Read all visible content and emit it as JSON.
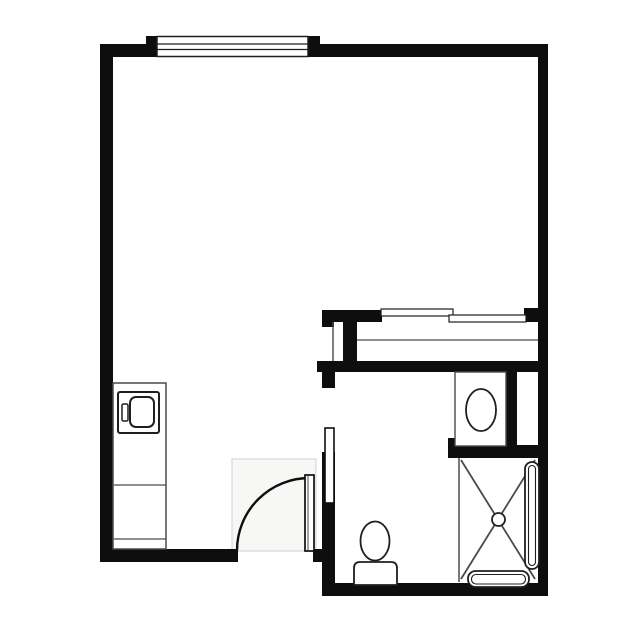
{
  "canvas": {
    "width": 636,
    "height": 636,
    "background": "#ffffff"
  },
  "palette": {
    "wall": "#0e0e0e",
    "fixture": "#1f1f1f",
    "line": "#4a4a4a",
    "swing_fill": "#f7f7f6",
    "swing_stroke": "#d8d8d8",
    "white": "#ffffff"
  },
  "shapes": [
    {
      "name": "door-swing-area",
      "type": "rect",
      "attrs": {
        "x": 232,
        "y": 459,
        "width": 84,
        "height": 92
      },
      "fill": "swing_fill",
      "stroke": "swing_stroke",
      "sw": 1.2
    },
    {
      "name": "wall-top-left",
      "type": "rect",
      "attrs": {
        "x": 100,
        "y": 44,
        "width": 46,
        "height": 13
      },
      "fill": "wall"
    },
    {
      "name": "window-jamb-left",
      "type": "rect",
      "attrs": {
        "x": 146,
        "y": 36,
        "width": 12,
        "height": 21
      },
      "fill": "wall"
    },
    {
      "name": "window-jamb-right",
      "type": "rect",
      "attrs": {
        "x": 308,
        "y": 36,
        "width": 12,
        "height": 21
      },
      "fill": "wall"
    },
    {
      "name": "wall-top-right",
      "type": "rect",
      "attrs": {
        "x": 320,
        "y": 44,
        "width": 228,
        "height": 13
      },
      "fill": "wall"
    },
    {
      "name": "wall-left",
      "type": "rect",
      "attrs": {
        "x": 100,
        "y": 44,
        "width": 13,
        "height": 518
      },
      "fill": "wall"
    },
    {
      "name": "wall-right",
      "type": "rect",
      "attrs": {
        "x": 538,
        "y": 44,
        "width": 10,
        "height": 552
      },
      "fill": "wall"
    },
    {
      "name": "wall-bottom-main",
      "type": "rect",
      "attrs": {
        "x": 100,
        "y": 549,
        "width": 138,
        "height": 13
      },
      "fill": "wall"
    },
    {
      "name": "wall-entry-right-stub",
      "type": "rect",
      "attrs": {
        "x": 313,
        "y": 549,
        "width": 12,
        "height": 13
      },
      "fill": "wall"
    },
    {
      "name": "wall-closet-top",
      "type": "rect",
      "attrs": {
        "x": 322,
        "y": 310,
        "width": 60,
        "height": 12
      },
      "fill": "wall"
    },
    {
      "name": "wall-closet-top-cap",
      "type": "rect",
      "attrs": {
        "x": 322,
        "y": 310,
        "width": 12,
        "height": 17
      },
      "fill": "wall"
    },
    {
      "name": "wall-closet-right-stub",
      "type": "rect",
      "attrs": {
        "x": 524,
        "y": 308,
        "width": 16,
        "height": 14
      },
      "fill": "wall"
    },
    {
      "name": "wall-closet-divider",
      "type": "rect",
      "attrs": {
        "x": 343,
        "y": 322,
        "width": 14,
        "height": 40
      },
      "fill": "wall"
    },
    {
      "name": "wall-closet-bottom",
      "type": "rect",
      "attrs": {
        "x": 317,
        "y": 361,
        "width": 231,
        "height": 11
      },
      "fill": "wall"
    },
    {
      "name": "wall-bath-door-stub",
      "type": "rect",
      "attrs": {
        "x": 322,
        "y": 372,
        "width": 13,
        "height": 16
      },
      "fill": "wall"
    },
    {
      "name": "wall-bath-left",
      "type": "rect",
      "attrs": {
        "x": 322,
        "y": 452,
        "width": 13,
        "height": 144
      },
      "fill": "wall"
    },
    {
      "name": "wall-vanity-right",
      "type": "rect",
      "attrs": {
        "x": 506,
        "y": 372,
        "width": 11,
        "height": 74
      },
      "fill": "wall"
    },
    {
      "name": "wall-above-shower",
      "type": "rect",
      "attrs": {
        "x": 448,
        "y": 445,
        "width": 100,
        "height": 13
      },
      "fill": "wall"
    },
    {
      "name": "wall-above-shower-cap",
      "type": "rect",
      "attrs": {
        "x": 448,
        "y": 438,
        "width": 10,
        "height": 8
      },
      "fill": "wall"
    },
    {
      "name": "wall-bath-bottom",
      "type": "rect",
      "attrs": {
        "x": 322,
        "y": 583,
        "width": 226,
        "height": 13
      },
      "fill": "wall"
    },
    {
      "name": "window-frame",
      "type": "rect",
      "attrs": {
        "x": 157,
        "y": 36.5,
        "width": 151,
        "height": 20
      },
      "fill": "white",
      "stroke": "fixture",
      "sw": 1.5
    },
    {
      "name": "window-mullion-upper",
      "type": "line",
      "attrs": {
        "x1": 157,
        "y1": 44,
        "x2": 308,
        "y2": 44
      },
      "stroke": "fixture",
      "sw": 1.2
    },
    {
      "name": "window-mullion-lower",
      "type": "line",
      "attrs": {
        "x1": 157,
        "y1": 49.5,
        "x2": 308,
        "y2": 49.5
      },
      "stroke": "fixture",
      "sw": 1.2
    },
    {
      "name": "closet-side-line",
      "type": "line",
      "attrs": {
        "x1": 333,
        "y1": 322,
        "x2": 333,
        "y2": 361
      },
      "stroke": "line",
      "sw": 1.4
    },
    {
      "name": "closet-shelf-line",
      "type": "line",
      "attrs": {
        "x1": 357,
        "y1": 340,
        "x2": 538,
        "y2": 340
      },
      "stroke": "line",
      "sw": 1.3
    },
    {
      "name": "closet-sliding-door-left",
      "type": "rect",
      "attrs": {
        "x": 381,
        "y": 309,
        "width": 72,
        "height": 7
      },
      "fill": "white",
      "stroke": "fixture",
      "sw": 1.2
    },
    {
      "name": "closet-sliding-door-right",
      "type": "rect",
      "attrs": {
        "x": 449,
        "y": 315,
        "width": 77,
        "height": 7
      },
      "fill": "white",
      "stroke": "fixture",
      "sw": 1.2
    },
    {
      "name": "kitchenette-cabinet",
      "type": "rect",
      "attrs": {
        "x": 113,
        "y": 383,
        "width": 53,
        "height": 166
      },
      "fill": "white",
      "stroke": "line",
      "sw": 1.5
    },
    {
      "name": "cabinet-shelf-line-upper",
      "type": "line",
      "attrs": {
        "x1": 114,
        "y1": 485,
        "x2": 166,
        "y2": 485
      },
      "stroke": "line",
      "sw": 1.2
    },
    {
      "name": "cabinet-shelf-line-lower",
      "type": "line",
      "attrs": {
        "x1": 114,
        "y1": 539,
        "x2": 166,
        "y2": 539
      },
      "stroke": "line",
      "sw": 1.2
    },
    {
      "name": "appliance-body",
      "type": "rect",
      "attrs": {
        "x": 118,
        "y": 392,
        "width": 41,
        "height": 41,
        "rx": 2
      },
      "fill": "white",
      "stroke": "fixture",
      "sw": 2
    },
    {
      "name": "appliance-door",
      "type": "rect",
      "attrs": {
        "x": 130,
        "y": 397,
        "width": 24,
        "height": 30,
        "rx": 6
      },
      "fill": "white",
      "stroke": "fixture",
      "sw": 2
    },
    {
      "name": "appliance-handle",
      "type": "rect",
      "attrs": {
        "x": 122,
        "y": 404,
        "width": 6,
        "height": 17,
        "rx": 1.5
      },
      "fill": "white",
      "stroke": "fixture",
      "sw": 1.5
    },
    {
      "name": "entry-door-swing-arc",
      "type": "path",
      "attrs": {
        "d": "M 309.5 478 A 72.5 72.5 0 0 0 237 550.5"
      },
      "fill": "none",
      "stroke": "wall",
      "sw": 2.4
    },
    {
      "name": "entry-door-leaf",
      "type": "rect",
      "attrs": {
        "x": 305,
        "y": 475,
        "width": 9,
        "height": 76
      },
      "fill": "white",
      "stroke": "wall",
      "sw": 1.7
    },
    {
      "name": "entry-door-leaf-inner-line",
      "type": "line",
      "attrs": {
        "x1": 308,
        "y1": 476,
        "x2": 308,
        "y2": 550
      },
      "stroke": "line",
      "sw": 1
    },
    {
      "name": "bathroom-pocket-door-panel",
      "type": "rect",
      "attrs": {
        "x": 325,
        "y": 428,
        "width": 9,
        "height": 75
      },
      "fill": "white",
      "stroke": "wall",
      "sw": 1.6
    },
    {
      "name": "vanity-counter",
      "type": "rect",
      "attrs": {
        "x": 455,
        "y": 372,
        "width": 51,
        "height": 74
      },
      "fill": "white",
      "stroke": "line",
      "sw": 1.4
    },
    {
      "name": "vanity-sink-basin",
      "type": "ellipse",
      "attrs": {
        "cx": 481,
        "cy": 410,
        "rx": 15,
        "ry": 21
      },
      "fill": "white",
      "stroke": "fixture",
      "sw": 1.8
    },
    {
      "name": "shower-curb-line",
      "type": "line",
      "attrs": {
        "x1": 459,
        "y1": 458,
        "x2": 459,
        "y2": 582
      },
      "stroke": "line",
      "sw": 1.5
    },
    {
      "name": "shower-diagonal-a",
      "type": "line",
      "attrs": {
        "x1": 461,
        "y1": 460,
        "x2": 535,
        "y2": 579
      },
      "stroke": "line",
      "sw": 1.8
    },
    {
      "name": "shower-diagonal-b",
      "type": "line",
      "attrs": {
        "x1": 535,
        "y1": 460,
        "x2": 461,
        "y2": 579
      },
      "stroke": "line",
      "sw": 1.8
    },
    {
      "name": "shower-grab-bar-right",
      "type": "rect",
      "attrs": {
        "x": 525,
        "y": 462,
        "width": 14,
        "height": 107,
        "rx": 7
      },
      "fill": "white",
      "stroke": "fixture",
      "sw": 1.8
    },
    {
      "name": "shower-grab-bar-right-inner",
      "type": "rect",
      "attrs": {
        "x": 528.5,
        "y": 465.5,
        "width": 7,
        "height": 100,
        "rx": 3.5
      },
      "fill": "none",
      "stroke": "fixture",
      "sw": 1.1
    },
    {
      "name": "shower-grab-bar-bottom",
      "type": "rect",
      "attrs": {
        "x": 468,
        "y": 571,
        "width": 61,
        "height": 16,
        "rx": 7.5
      },
      "fill": "white",
      "stroke": "fixture",
      "sw": 1.8
    },
    {
      "name": "shower-grab-bar-bottom-inner",
      "type": "rect",
      "attrs": {
        "x": 471.5,
        "y": 574.5,
        "width": 54,
        "height": 9.5,
        "rx": 4.5
      },
      "fill": "none",
      "stroke": "fixture",
      "sw": 1.1
    },
    {
      "name": "shower-drain",
      "type": "circle",
      "attrs": {
        "cx": 498.5,
        "cy": 519.5,
        "r": 6.5
      },
      "fill": "white",
      "stroke": "fixture",
      "sw": 1.8
    },
    {
      "name": "toilet-bowl",
      "type": "ellipse",
      "attrs": {
        "cx": 375,
        "cy": 541,
        "rx": 14.5,
        "ry": 19.5
      },
      "fill": "white",
      "stroke": "fixture",
      "sw": 1.8
    },
    {
      "name": "toilet-tank",
      "type": "path",
      "attrs": {
        "d": "M 354 585 L 354 568 Q 354 562 360 562 L 391 562 Q 397 562 397 568 L 397 585 Z"
      },
      "fill": "white",
      "stroke": "fixture",
      "sw": 1.8
    }
  ]
}
